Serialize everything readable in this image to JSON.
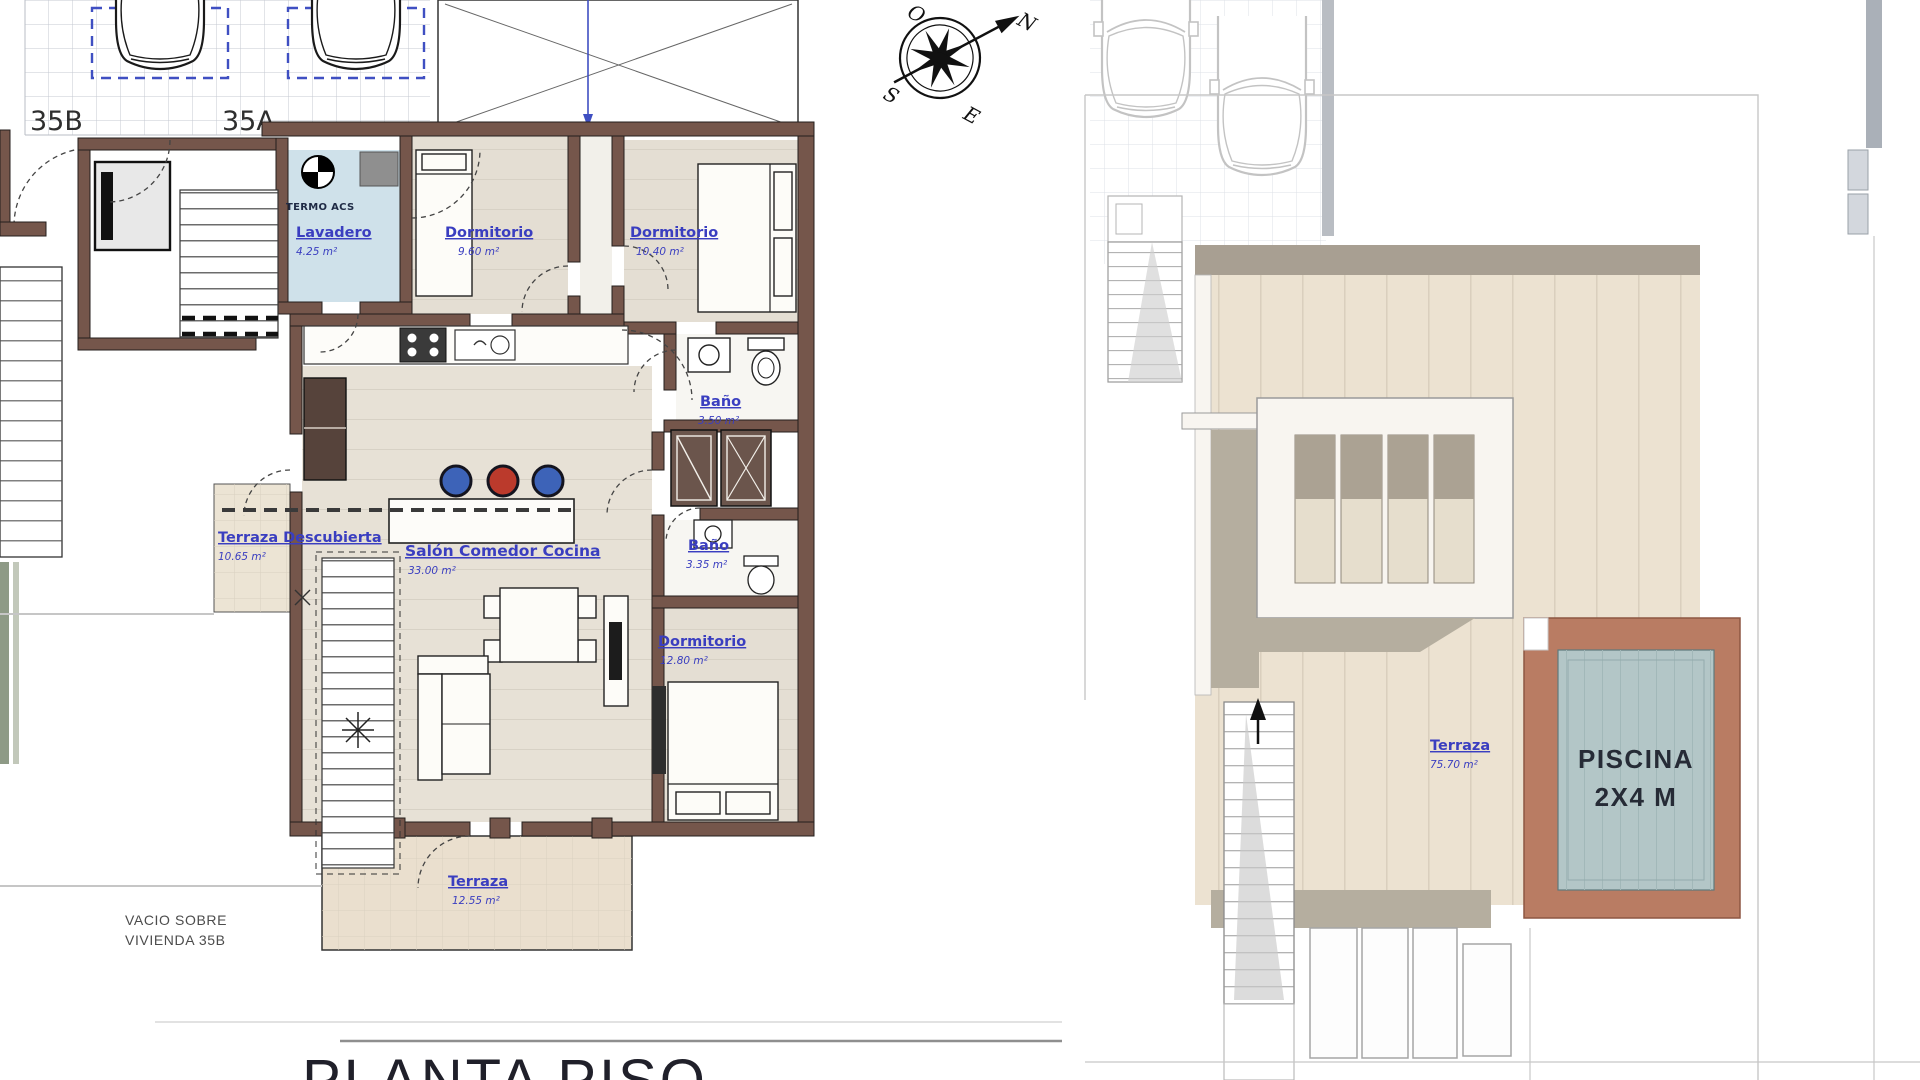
{
  "title": {
    "text": "PLANTA PISO"
  },
  "left_plan": {
    "unit_left": "35B",
    "unit_right": "35A",
    "termo": "TERMO ACS",
    "lavadero": {
      "name": "Lavadero",
      "area": "4.25 m²"
    },
    "dorm1": {
      "name": "Dormitorio",
      "area": "9.60 m²"
    },
    "dorm2": {
      "name": "Dormitorio",
      "area": "10.40 m²"
    },
    "bano1": {
      "name": "Baño",
      "area": "3.50 m²"
    },
    "terraza_descubierta": {
      "name": "Terraza Descubierta",
      "area": "10.65 m²"
    },
    "salon": {
      "name": "Salón Comedor Cocina",
      "area": "33.00 m²"
    },
    "bano2": {
      "name": "Baño",
      "area": "3.35 m²"
    },
    "dorm3": {
      "name": "Dormitorio",
      "area": "12.80 m²"
    },
    "terraza": {
      "name": "Terraza",
      "area": "12.55 m²"
    },
    "void_line1": "VACIO SOBRE",
    "void_line2": "VIVIENDA 35B"
  },
  "right_plan": {
    "terraza": {
      "name": "Terraza",
      "area": "75.70 m²"
    },
    "piscina_line1": "PISCINA",
    "piscina_line2": "2X4 M"
  },
  "compass": {
    "n": "N",
    "s": "S",
    "e": "E",
    "w": "O"
  },
  "colors": {
    "wall": "#75564b",
    "label_blue": "#3a3ec0",
    "floor_beige": "#e4ded3",
    "lavadero_blue": "#cfe1ea",
    "terrace_tan": "#ece2d1",
    "pool_water": "#b3c6c7",
    "pool_deck": "#b97c63",
    "stool_blue": "#3d63b8",
    "stool_red": "#bb3a2c",
    "parking_dash_blue": "#3f4fc2"
  }
}
